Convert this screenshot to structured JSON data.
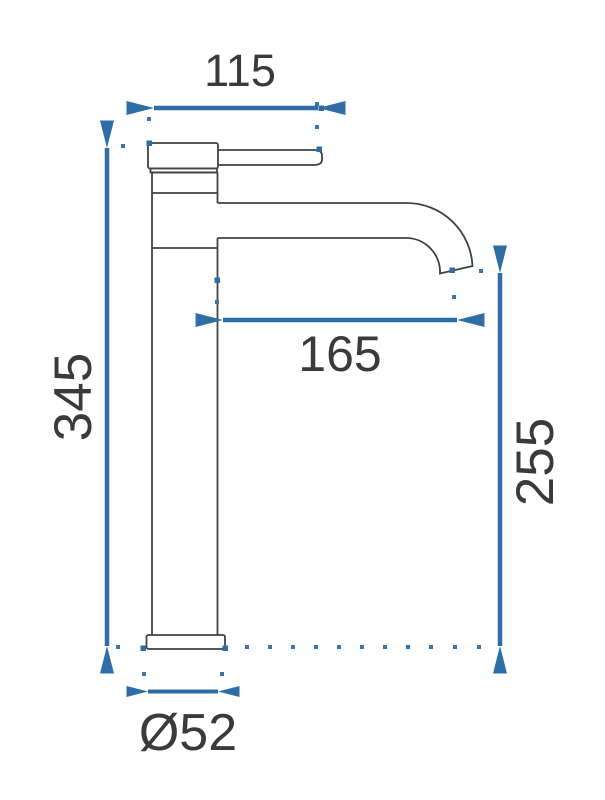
{
  "drawing": {
    "figure": "tall-single-lever-basin-faucet-side-view",
    "labels": {
      "top_width": "115",
      "spout_reach": "165",
      "total_height": "345",
      "outlet_height": "255",
      "base_diameter": "Ø52"
    },
    "colors": {
      "dimension_accent": "#2e6da6",
      "extension_dots": "#3a74ac",
      "outline": "#3f4246",
      "label_text": "#3a3a3a",
      "background": "#ffffff"
    }
  }
}
